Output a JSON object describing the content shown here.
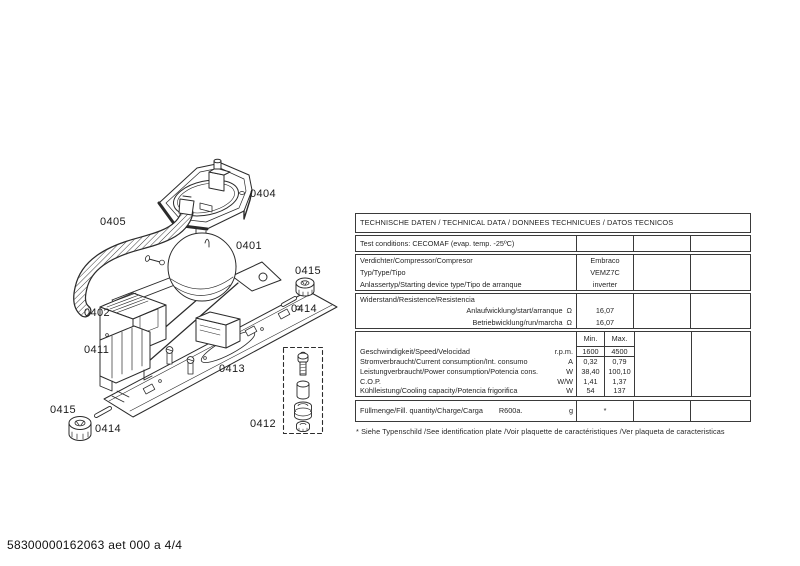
{
  "colors": {
    "ink": "#2b2b2b",
    "table_border": "#3a3a3a",
    "background": "#ffffff"
  },
  "page": {
    "doc_code": "58300000162063 aet 000 a 4/4"
  },
  "diagram": {
    "labels": [
      {
        "text": "0404"
      },
      {
        "text": "0405"
      },
      {
        "text": "0401"
      },
      {
        "text": "0415"
      },
      {
        "text": "0414"
      },
      {
        "text": "0402"
      },
      {
        "text": "0411"
      },
      {
        "text": "0413"
      },
      {
        "text": "0415"
      },
      {
        "text": "0414"
      },
      {
        "text": "0412"
      }
    ]
  },
  "table": {
    "title": "TECHNISCHE DATEN / TECHNICAL DATA / DONNEES TECHNICUES / DATOS TECNICOS",
    "test_conditions": "Test conditions:  CECOMAF (evap. temp. -25ºC)",
    "compressor": {
      "rows": [
        {
          "label": "Verdichter/Compressor/Compresor",
          "value": "Embraco"
        },
        {
          "label": "Typ/Type/Tipo",
          "value": "VEMZ7C"
        },
        {
          "label": "Anlassertyp/Starting device type/Tipo de arranque",
          "value": "inverter"
        }
      ]
    },
    "resistance": {
      "heading": "Widerstand/Resistence/Resistencia",
      "rows": [
        {
          "label": "Anlaufwicklung/start/arranque",
          "unit": "Ω",
          "value": "16,07"
        },
        {
          "label": "Betriebwicklung/run/marcha",
          "unit": "Ω",
          "value": "16,07"
        }
      ]
    },
    "performance": {
      "min_header": "Min.",
      "max_header": "Max.",
      "rows": [
        {
          "label": "Geschwindigkeit/Speed/Velocidad",
          "unit": "r.p.m.",
          "min": "1600",
          "max": "4500"
        },
        {
          "label": "Stromverbraucht/Current consumption/Int. consumo",
          "unit": "A",
          "min": "0,32",
          "max": "0,79"
        },
        {
          "label": "Leistungverbraucht/Power consumption/Potencia cons.",
          "unit": "W",
          "min": "38,40",
          "max": "100,10"
        },
        {
          "label": "C.O.P.",
          "unit": "W/W",
          "min": "1,41",
          "max": "1,37"
        },
        {
          "label": "Kühlleistung/Cooling capacity/Potencia frigorifica",
          "unit": "W",
          "min": "54",
          "max": "137"
        }
      ]
    },
    "charge": {
      "label": "Füllmenge/Fill. quantity/Charge/Carga",
      "refrigerant": "R600a.",
      "unit": "g",
      "value": "*"
    },
    "footnote": "* Siehe Typenschild /See identification plate /Voir plaquette de caractéristiques /Ver plaqueta de caracteristicas"
  }
}
